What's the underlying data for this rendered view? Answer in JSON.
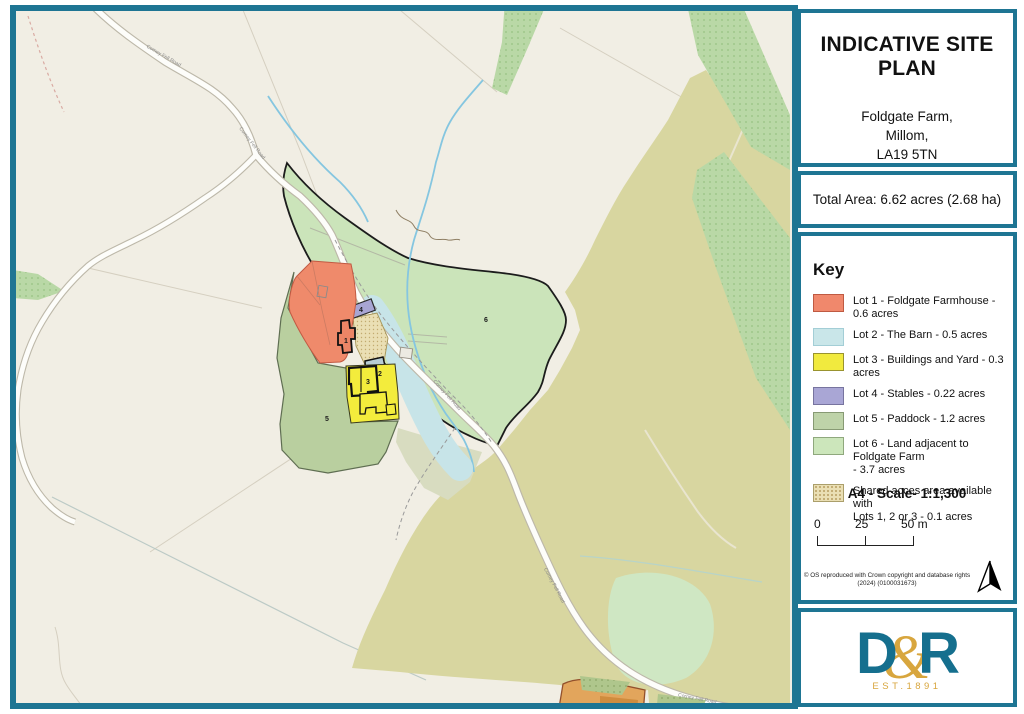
{
  "map": {
    "road_label": "Corney Fell Road",
    "lot_markers": [
      "1",
      "2",
      "3",
      "4",
      "5",
      "6"
    ]
  },
  "panel": {
    "title": "INDICATIVE SITE PLAN",
    "address": [
      "Foldgate Farm,",
      "Millom,",
      "LA19 5TN"
    ],
    "total_area": "Total Area: 6.62 acres (2.68 ha)",
    "key": {
      "heading": "Key",
      "items": [
        {
          "line1": "Lot 1 - Foldgate Farmhouse - 0.6 acres",
          "line2": "",
          "color": "#f0886c",
          "border": "#bf5a42"
        },
        {
          "line1": "Lot 2 - The Barn - 0.5 acres",
          "line2": "",
          "color": "#c9e6e9",
          "border": "#a3ced6"
        },
        {
          "line1": "Lot 3 - Buildings and Yard - 0.3 acres",
          "line2": "",
          "color": "#f1ea3e",
          "border": "#99932f"
        },
        {
          "line1": "Lot 4 - Stables - 0.22 acres",
          "line2": "",
          "color": "#a9a6d5",
          "border": "#77749f"
        },
        {
          "line1": "Lot 5 - Paddock - 1.2 acres",
          "line2": "",
          "color": "#bed3a9",
          "border": "#879a74"
        },
        {
          "line1": "Lot 6 - Land adjacent to Foldgate Farm",
          "line2": "- 3.7 acres",
          "color": "#cce6bb",
          "border": "#8fa87d"
        },
        {
          "line1": "Shared acces area available with",
          "line2": "Lots 1, 2 or 3 - 0.1 acres",
          "color": "#eadfb4",
          "border": "#ab9f6b"
        }
      ]
    },
    "scale": {
      "label": "A4 - Scale- 1:1,300",
      "t0": "0",
      "t25": "25",
      "t50": "50 m"
    },
    "copyright": [
      "© OS reproduced with Crown copyright and database rights",
      "(2024) (0100031673)"
    ],
    "logo": {
      "d": "D",
      "amp": "&",
      "r": "R",
      "est": "EST.1891"
    }
  },
  "colors": {
    "frame_teal": "#1e7593",
    "logo_teal": "#156f8e",
    "logo_gold": "#d8a63e",
    "map_background": "#f1eee4",
    "farmland_olive": "#d8d6a0",
    "woodland_green": "#b9d8a6",
    "lot6_green": "#cbe4ba",
    "water_blue": "#85c6e0"
  }
}
